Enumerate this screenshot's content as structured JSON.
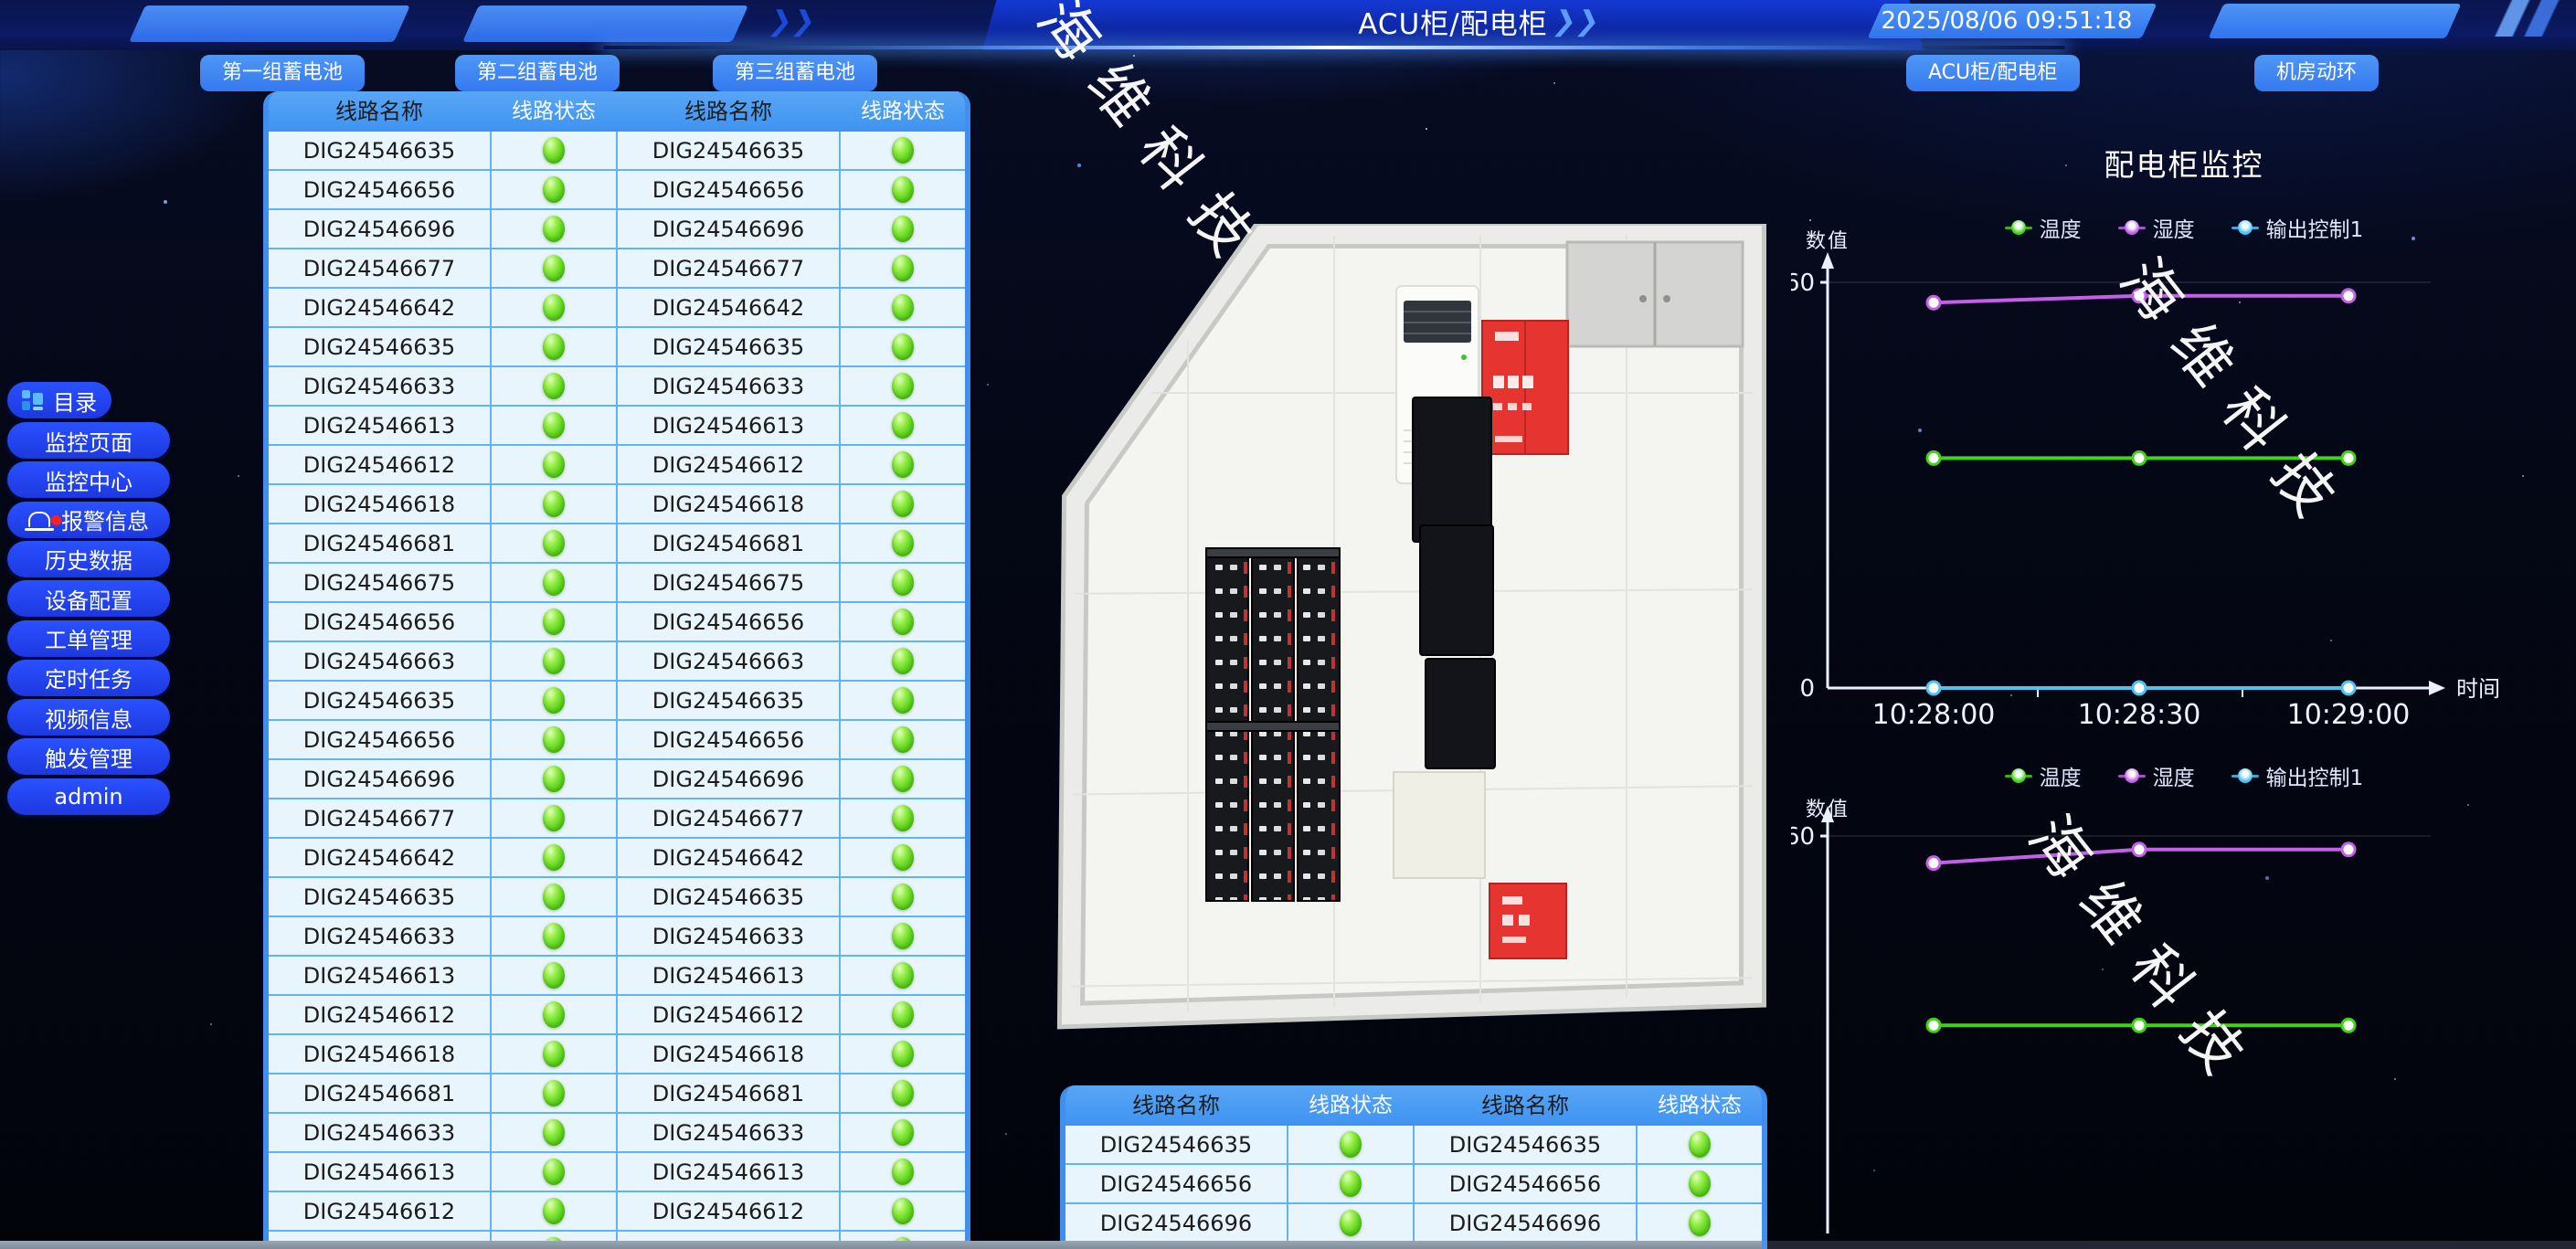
{
  "header": {
    "title": "ACU柜/配电柜",
    "datetime": "2025/08/06 09:51:18"
  },
  "toolbar": {
    "battery_buttons": [
      "第一组蓄电池",
      "第二组蓄电池",
      "第三组蓄电池"
    ],
    "right_buttons": [
      "ACU柜/配电柜",
      "机房动环"
    ]
  },
  "sidebar": {
    "items": [
      {
        "label": "目录",
        "icon": "menu-grid-icon"
      },
      {
        "label": "监控页面"
      },
      {
        "label": "监控中心"
      },
      {
        "label": "报警信息",
        "icon": "alarm-bell-icon",
        "badge": true
      },
      {
        "label": "历史数据"
      },
      {
        "label": "设备配置"
      },
      {
        "label": "工单管理"
      },
      {
        "label": "定时任务"
      },
      {
        "label": "视频信息"
      },
      {
        "label": "触发管理"
      },
      {
        "label": "admin"
      }
    ]
  },
  "watermark": "海维科技",
  "left_table": {
    "headers": [
      "线路名称",
      "线路状态",
      "线路名称",
      "线路状态"
    ],
    "rows": [
      [
        "DIG24546635",
        "on",
        "DIG24546635",
        "on"
      ],
      [
        "DIG24546656",
        "on",
        "DIG24546656",
        "on"
      ],
      [
        "DIG24546696",
        "on",
        "DIG24546696",
        "on"
      ],
      [
        "DIG24546677",
        "on",
        "DIG24546677",
        "on"
      ],
      [
        "DIG24546642",
        "on",
        "DIG24546642",
        "on"
      ],
      [
        "DIG24546635",
        "on",
        "DIG24546635",
        "on"
      ],
      [
        "DIG24546633",
        "on",
        "DIG24546633",
        "on"
      ],
      [
        "DIG24546613",
        "on",
        "DIG24546613",
        "on"
      ],
      [
        "DIG24546612",
        "on",
        "DIG24546612",
        "on"
      ],
      [
        "DIG24546618",
        "on",
        "DIG24546618",
        "on"
      ],
      [
        "DIG24546681",
        "on",
        "DIG24546681",
        "on"
      ],
      [
        "DIG24546675",
        "on",
        "DIG24546675",
        "on"
      ],
      [
        "DIG24546656",
        "on",
        "DIG24546656",
        "on"
      ],
      [
        "DIG24546663",
        "on",
        "DIG24546663",
        "on"
      ],
      [
        "DIG24546635",
        "on",
        "DIG24546635",
        "on"
      ],
      [
        "DIG24546656",
        "on",
        "DIG24546656",
        "on"
      ],
      [
        "DIG24546696",
        "on",
        "DIG24546696",
        "on"
      ],
      [
        "DIG24546677",
        "on",
        "DIG24546677",
        "on"
      ],
      [
        "DIG24546642",
        "on",
        "DIG24546642",
        "on"
      ],
      [
        "DIG24546635",
        "on",
        "DIG24546635",
        "on"
      ],
      [
        "DIG24546633",
        "on",
        "DIG24546633",
        "on"
      ],
      [
        "DIG24546613",
        "on",
        "DIG24546613",
        "on"
      ],
      [
        "DIG24546612",
        "on",
        "DIG24546612",
        "on"
      ],
      [
        "DIG24546618",
        "on",
        "DIG24546618",
        "on"
      ],
      [
        "DIG24546681",
        "on",
        "DIG24546681",
        "on"
      ],
      [
        "DIG24546633",
        "on",
        "DIG24546633",
        "on"
      ],
      [
        "DIG24546613",
        "on",
        "DIG24546613",
        "on"
      ],
      [
        "DIG24546612",
        "on",
        "DIG24546612",
        "on"
      ],
      [
        "DIG24546618",
        "on",
        "DIG24546618",
        "on"
      ]
    ]
  },
  "bottom_table": {
    "headers": [
      "线路名称",
      "线路状态",
      "线路名称",
      "线路状态"
    ],
    "rows": [
      [
        "DIG24546635",
        "on",
        "DIG24546635",
        "on"
      ],
      [
        "DIG24546656",
        "on",
        "DIG24546656",
        "on"
      ],
      [
        "DIG24546696",
        "on",
        "DIG24546696",
        "on"
      ],
      [
        "DIG24546677",
        "on",
        "DIG24546677",
        "on"
      ]
    ]
  },
  "chart_data": [
    {
      "type": "line",
      "title": "配电柜监控",
      "ylabel": "数值",
      "xlabel": "时间",
      "x": [
        "10:28:00",
        "10:28:30",
        "10:29:00"
      ],
      "ylim": [
        0,
        60
      ],
      "yticks": [
        0,
        60
      ],
      "legend_position": "top",
      "grid": false,
      "series": [
        {
          "name": "温度",
          "color": "#3fd414",
          "values": [
            34,
            34,
            34
          ]
        },
        {
          "name": "湿度",
          "color": "#c45fe8",
          "values": [
            57,
            58,
            58
          ]
        },
        {
          "name": "输出控制1",
          "color": "#49c3f0",
          "values": [
            0,
            0,
            0
          ]
        }
      ]
    },
    {
      "type": "line",
      "title": "",
      "ylabel": "数值",
      "xlabel": "时间",
      "x": [
        "10:28:00",
        "10:28:30",
        "10:29:00"
      ],
      "ylim": [
        0,
        60
      ],
      "yticks": [
        60
      ],
      "legend_position": "top",
      "grid": false,
      "series": [
        {
          "name": "温度",
          "color": "#3fd414",
          "values": [
            32,
            32,
            32
          ]
        },
        {
          "name": "湿度",
          "color": "#c45fe8",
          "values": [
            56,
            58,
            58
          ]
        },
        {
          "name": "输出控制1",
          "color": "#49c3f0",
          "values": [
            0,
            0,
            0
          ]
        }
      ]
    }
  ],
  "colors": {
    "accent_blue": "#3b82f6",
    "sidebar_blue": "#2240ee",
    "table_header_blue": "#4596f2",
    "row_bg": "#e9f5fd",
    "status_green": "#52cc16"
  }
}
